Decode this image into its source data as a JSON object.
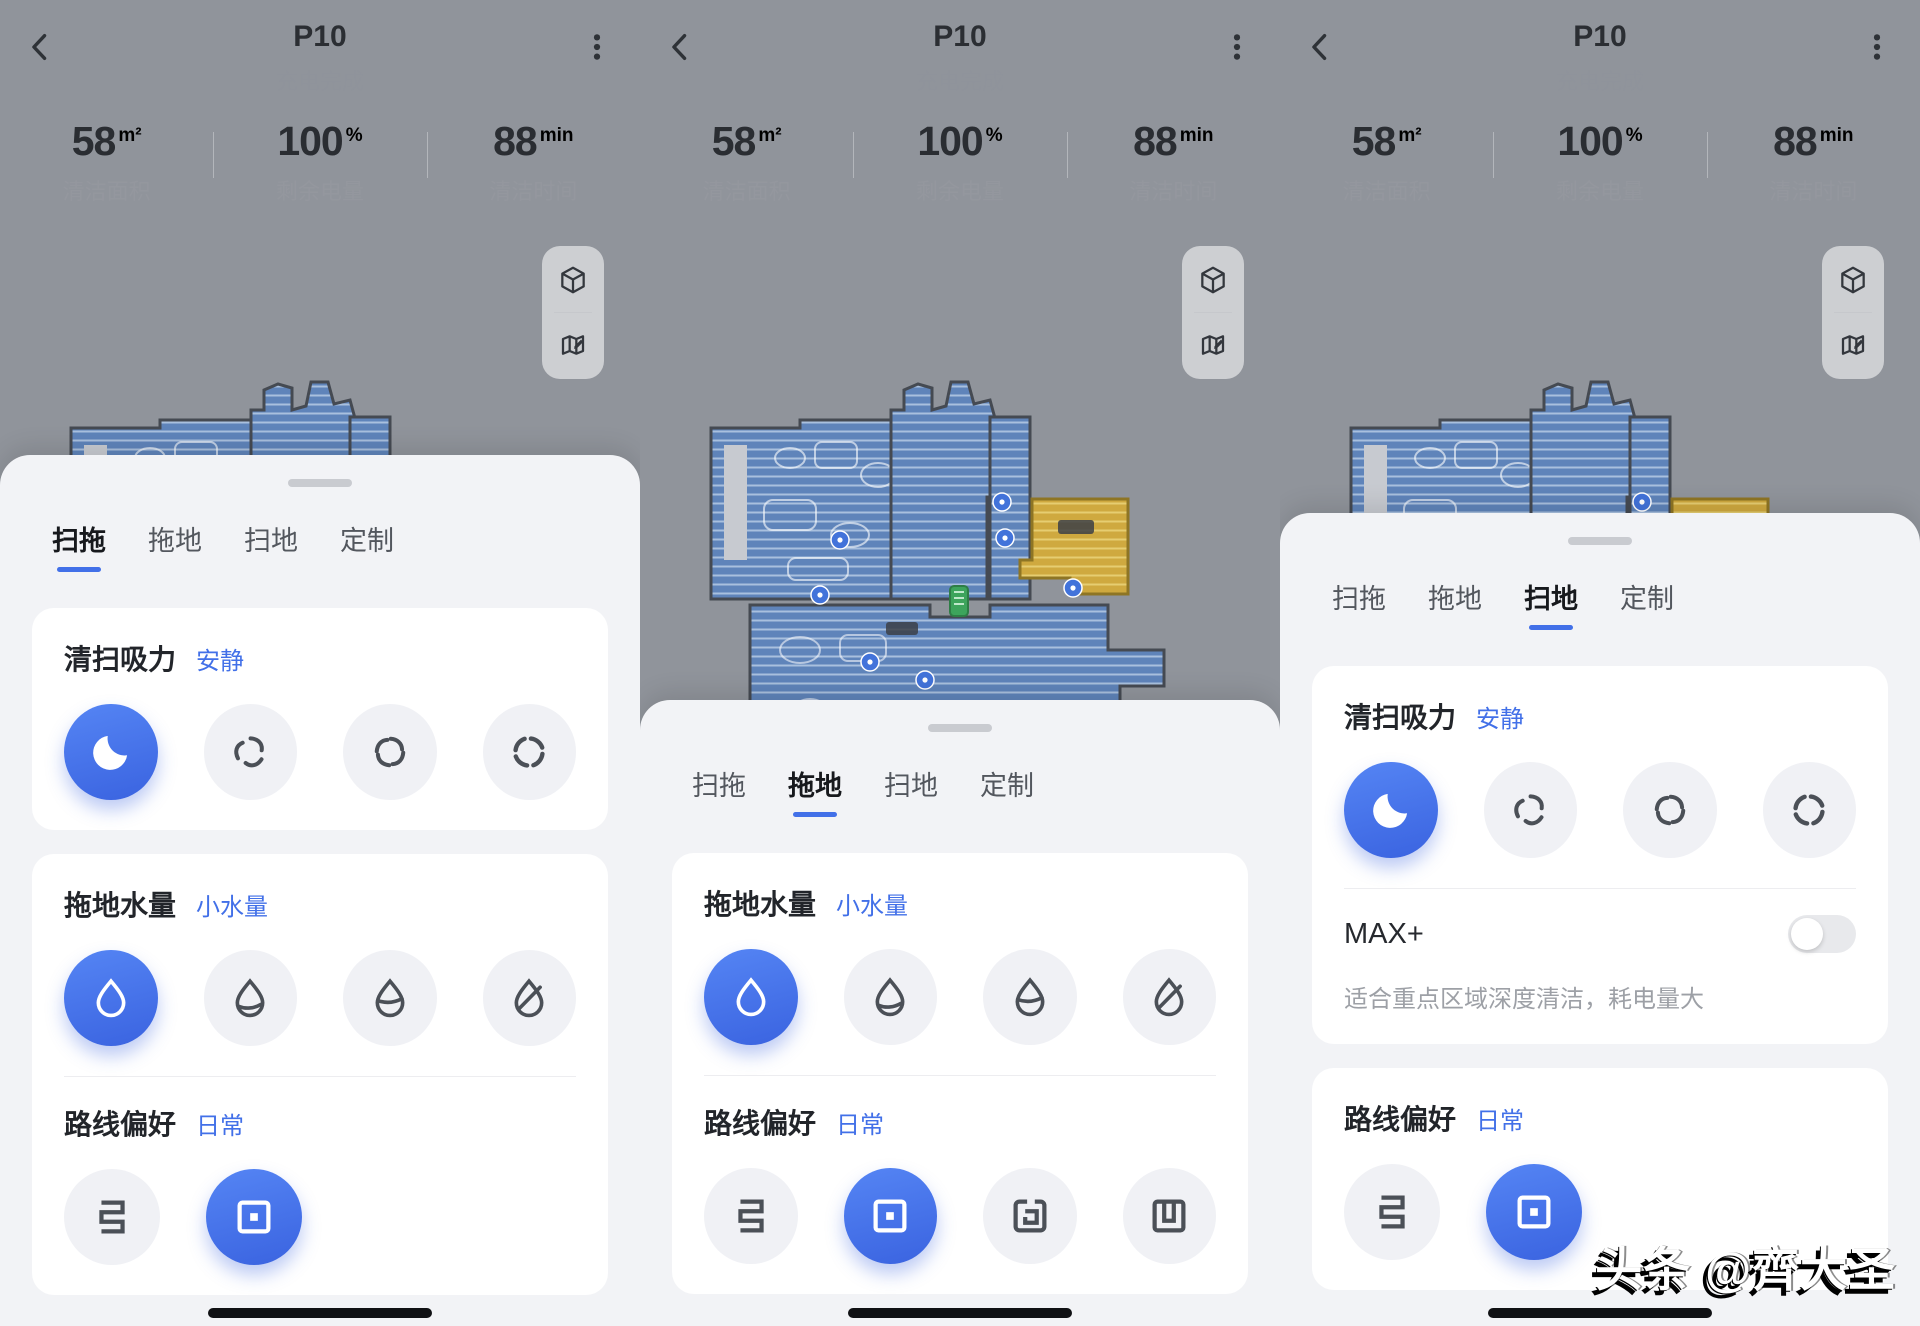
{
  "colors": {
    "accent": "#4270e8",
    "map_background": "#90949b",
    "map_room_blue": "#5f84ba",
    "map_room_yellow": "#cfa93f",
    "dock_green": "#3da45c"
  },
  "header": {
    "title": "P10",
    "status": "充电完成"
  },
  "stats": [
    {
      "value": "58",
      "unit": "m²",
      "label": "清洁面积"
    },
    {
      "value": "100",
      "unit": "%",
      "label": "剩余电量"
    },
    {
      "value": "88",
      "unit": "min",
      "label": "清洁时间"
    }
  ],
  "map_controls": {
    "view_3d_icon": "cube-3d",
    "edit_map_icon": "map-edit"
  },
  "tabs": [
    {
      "name": "sweep-mop",
      "label": "扫拖"
    },
    {
      "name": "mop",
      "label": "拖地"
    },
    {
      "name": "sweep",
      "label": "扫地"
    },
    {
      "name": "custom",
      "label": "定制"
    }
  ],
  "panels": [
    {
      "active_tab": 0
    },
    {
      "active_tab": 1
    },
    {
      "active_tab": 2
    }
  ],
  "sections": {
    "suction": {
      "title": "清扫吸力",
      "value": "安静",
      "options": [
        {
          "name": "quiet",
          "icon": "moon",
          "selected": true
        },
        {
          "name": "standard",
          "icon": "fan-1"
        },
        {
          "name": "strong",
          "icon": "fan-2"
        },
        {
          "name": "turbo",
          "icon": "fan-3"
        }
      ]
    },
    "water": {
      "title": "拖地水量",
      "value": "小水量",
      "options": [
        {
          "name": "small",
          "icon": "drop-full",
          "selected": true
        },
        {
          "name": "medium",
          "icon": "drop-low"
        },
        {
          "name": "large",
          "icon": "drop-mid"
        },
        {
          "name": "custom",
          "icon": "drop-slash"
        }
      ]
    },
    "route": {
      "title": "路线偏好",
      "value": "日常",
      "options_basic": [
        {
          "name": "fast",
          "icon": "route-zigzag"
        },
        {
          "name": "daily",
          "icon": "route-square",
          "selected": true
        }
      ],
      "options_full": [
        {
          "name": "fast",
          "icon": "route-zigzag"
        },
        {
          "name": "daily",
          "icon": "route-square",
          "selected": true
        },
        {
          "name": "intensive",
          "icon": "route-spiral"
        },
        {
          "name": "grid",
          "icon": "route-comb"
        }
      ]
    },
    "max": {
      "label": "MAX+",
      "description": "适合重点区域深度清洁，耗电量大",
      "enabled": false
    }
  },
  "watermark": "头条 @齊大圣"
}
